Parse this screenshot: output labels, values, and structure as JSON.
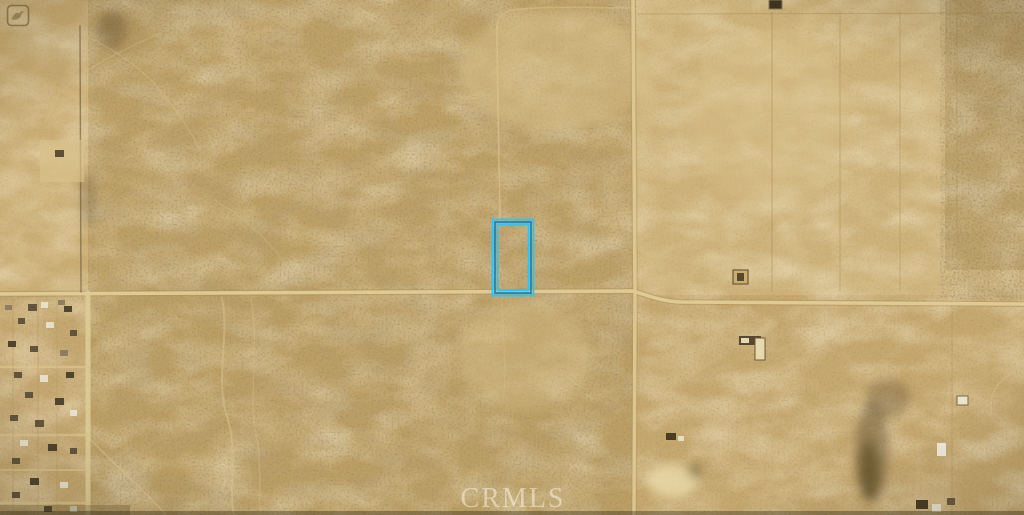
{
  "map": {
    "type": "satellite-aerial-photo",
    "watermark_text": "CRMLS",
    "corner_logo": "bird-badge-watermark",
    "palette": {
      "terrain_base": "#c6a870",
      "terrain_dark_scrub": "#b09153",
      "terrain_light_field": "#d4ba80",
      "road": "#e2cc97",
      "parcel_outline": "#33c3ee",
      "parcel_core_line": "#0f7fb4"
    },
    "parcel": {
      "x": 495,
      "y": 222,
      "w": 36,
      "h": 71
    },
    "features": {
      "roads": [
        {
          "name": "main-road-casing",
          "d": "M0 294 L633 291 C652 297 662 301 680 302 L1024 304",
          "stroke": "#ab8e58",
          "w": 6,
          "o": 0.45
        },
        {
          "name": "crossroad-casing",
          "d": "M633 0 L635 291 L634 515",
          "stroke": "#ab8e58",
          "w": 6,
          "o": 0.4
        },
        {
          "name": "main-road",
          "d": "M0 294 L633 291 C652 297 662 301 680 302 L1024 304",
          "stroke": "#e2cc97",
          "w": 3.5,
          "o": 0.95
        },
        {
          "name": "crossroad",
          "d": "M633 0 L635 291 L634 515",
          "stroke": "#e0ca95",
          "w": 3.5,
          "o": 0.9
        },
        {
          "name": "residential-edge-road",
          "d": "M88 293 L88 515",
          "stroke": "#decb96",
          "w": 5,
          "o": 0.9
        },
        {
          "name": "fence-line-west",
          "d": "M80 26 L81 292",
          "stroke": "#5e4a2b",
          "w": 1.4,
          "o": 0.55
        }
      ],
      "boundaries": [
        {
          "name": "field-line-1",
          "d": "M772 12 L772 291",
          "stroke": "#a3864f",
          "w": 1,
          "o": 0.5
        },
        {
          "name": "field-line-2",
          "d": "M840 12 L840 291",
          "stroke": "#a3864f",
          "w": 1,
          "o": 0.45
        },
        {
          "name": "field-line-3",
          "d": "M900 12 L900 291",
          "stroke": "#a3864f",
          "w": 1,
          "o": 0.4
        },
        {
          "name": "field-line-4",
          "d": "M957 12 L957 240",
          "stroke": "#a3864f",
          "w": 1,
          "o": 0.35
        },
        {
          "name": "field-line-top",
          "d": "M638 14 L1024 13",
          "stroke": "#a3864f",
          "w": 1,
          "o": 0.4
        },
        {
          "name": "field-line-se",
          "d": "M952 300 L952 515",
          "stroke": "#a3864f",
          "w": 1,
          "o": 0.35
        }
      ],
      "trails": [
        {
          "name": "trail-parcel-north",
          "d": "M497 26 C497 70 499 150 500 221",
          "stroke": "#dcc690",
          "w": 1.6,
          "o": 0.6
        },
        {
          "name": "trail-parcel-bend",
          "d": "M497 28 C497 16 505 10 520 9 C560 6 600 8 632 8",
          "stroke": "#dcc690",
          "w": 1.5,
          "o": 0.45
        },
        {
          "name": "trail-below-parcel",
          "d": "M501 294 C503 330 506 360 504 396",
          "stroke": "#d9c38d",
          "w": 1.3,
          "o": 0.3
        },
        {
          "name": "trail-wash-1",
          "d": "M222 298 C230 340 214 380 228 420 C238 452 228 488 234 515",
          "stroke": "#d9c38d",
          "w": 2,
          "o": 0.5
        },
        {
          "name": "trail-wash-2",
          "d": "M251 299 C260 348 247 398 257 440 C263 470 257 496 261 515",
          "stroke": "#d9c38d",
          "w": 1.5,
          "o": 0.35
        },
        {
          "name": "trail-diag-sw",
          "d": "M88 437 C118 468 148 494 166 515",
          "stroke": "#dcc690",
          "w": 1.8,
          "o": 0.5
        },
        {
          "name": "trail-nw-1",
          "d": "M32 18 C70 28 100 40 130 62 C160 84 185 120 200 150",
          "stroke": "#d9c38d",
          "w": 1.4,
          "o": 0.35
        },
        {
          "name": "trail-nw-2",
          "d": "M172 28 C140 42 105 58 78 76 C62 88 52 104 46 122",
          "stroke": "#d9c38d",
          "w": 1.4,
          "o": 0.3
        },
        {
          "name": "trail-center-wash",
          "d": "M300 291 C285 255 255 225 215 200",
          "stroke": "#d9c38d",
          "w": 1.5,
          "o": 0.25
        },
        {
          "name": "trail-east-curve",
          "d": "M1014 372 C996 382 988 396 992 414",
          "stroke": "#dcc690",
          "w": 1.5,
          "o": 0.4
        },
        {
          "name": "trail-junction-diag",
          "d": "M940 266 L906 294",
          "stroke": "#d9c38d",
          "w": 1.2,
          "o": 0.3
        }
      ],
      "streets": [
        {
          "name": "street-1",
          "d": "M0 367 L88 367",
          "stroke": "#d9c38d",
          "w": 2.5,
          "o": 0.8
        },
        {
          "name": "street-2",
          "d": "M0 435 L88 435",
          "stroke": "#d9c38d",
          "w": 2.5,
          "o": 0.8
        },
        {
          "name": "street-3",
          "d": "M0 470 L88 470",
          "stroke": "#d9c38d",
          "w": 2,
          "o": 0.7
        },
        {
          "name": "street-4",
          "d": "M0 503 L88 503",
          "stroke": "#d9c38d",
          "w": 2.5,
          "o": 0.8
        },
        {
          "name": "lot-line-1",
          "d": "M13 300 L13 510",
          "stroke": "#a88b55",
          "w": 0.8,
          "o": 0.4
        },
        {
          "name": "lot-line-2",
          "d": "M38 300 L38 510",
          "stroke": "#a88b55",
          "w": 0.8,
          "o": 0.4
        },
        {
          "name": "lot-line-3",
          "d": "M57 300 L57 510",
          "stroke": "#a88b55",
          "w": 0.8,
          "o": 0.35
        }
      ],
      "soft_shapes": [
        {
          "name": "light-area-topcenter",
          "cx": 555,
          "cy": 70,
          "rx": 95,
          "ry": 60,
          "fill": "#d8c089",
          "o": 0.5
        },
        {
          "name": "light-wash-center",
          "cx": 525,
          "cy": 355,
          "rx": 65,
          "ry": 55,
          "fill": "#d6bf88",
          "o": 0.4
        },
        {
          "name": "light-east-mid",
          "cx": 770,
          "cy": 120,
          "rx": 80,
          "ry": 90,
          "fill": "#d9c28c",
          "o": 0.35
        },
        {
          "name": "scrub-blob-1",
          "cx": 112,
          "cy": 30,
          "rx": 15,
          "ry": 20,
          "fill": "#5f4b2b",
          "o": 0.35
        },
        {
          "name": "scrub-blob-2",
          "cx": 88,
          "cy": 200,
          "rx": 9,
          "ry": 26,
          "fill": "#5f4b2b",
          "o": 0.3
        },
        {
          "name": "burn-scar-upper",
          "cx": 888,
          "cy": 398,
          "rx": 22,
          "ry": 19,
          "fill": "#6f5a38",
          "o": 0.4
        },
        {
          "name": "burn-scar-main",
          "cx": 872,
          "cy": 452,
          "rx": 17,
          "ry": 50,
          "fill": "#5e4c2c",
          "o": 0.45
        },
        {
          "name": "burn-scar-core",
          "cx": 869,
          "cy": 470,
          "rx": 10,
          "ry": 30,
          "fill": "#473717",
          "o": 0.5
        },
        {
          "name": "sand-pond",
          "cx": 672,
          "cy": 481,
          "rx": 25,
          "ry": 16,
          "fill": "#e8d7a6",
          "o": 0.85
        },
        {
          "name": "sand-pond-dark",
          "cx": 695,
          "cy": 471,
          "rx": 8,
          "ry": 6,
          "fill": "#54441f",
          "o": 0.55
        }
      ],
      "structures": [
        {
          "name": "small-building-topright",
          "x": 769,
          "y": 0,
          "w": 13,
          "h": 9,
          "fill": "#3f3522",
          "stroke": "#8a7a55",
          "sw": 1
        },
        {
          "name": "fenced-lot",
          "x": 733,
          "y": 270,
          "w": 15,
          "h": 14,
          "fill": "#c9ad72",
          "stroke": "#6d5937",
          "sw": 1.2
        },
        {
          "name": "fenced-lot-inner",
          "x": 737,
          "y": 273,
          "w": 7,
          "h": 8,
          "fill": "#58482c"
        },
        {
          "name": "farm-building-a",
          "x": 739,
          "y": 336,
          "w": 22,
          "h": 9,
          "fill": "#57472e"
        },
        {
          "name": "farm-building-b",
          "x": 755,
          "y": 338,
          "w": 10,
          "h": 22,
          "fill": "#e7d9ae",
          "stroke": "#6d5937",
          "sw": 1
        },
        {
          "name": "farm-building-c",
          "x": 741,
          "y": 338,
          "w": 8,
          "h": 5,
          "fill": "#e7d9ae"
        },
        {
          "name": "white-structure-1",
          "x": 957,
          "y": 396,
          "w": 11,
          "h": 9,
          "fill": "#eae3d0",
          "stroke": "#7a6a45",
          "sw": 1
        },
        {
          "name": "white-structure-2",
          "x": 937,
          "y": 443,
          "w": 9,
          "h": 13,
          "fill": "#efe9da"
        },
        {
          "name": "small-structure-east",
          "x": 666,
          "y": 433,
          "w": 10,
          "h": 7,
          "fill": "#4a3d27"
        },
        {
          "name": "small-structure-east-2",
          "x": 678,
          "y": 436,
          "w": 6,
          "h": 5,
          "fill": "#e5ddc8"
        },
        {
          "name": "homestead-patch",
          "x": 40,
          "y": 140,
          "w": 44,
          "h": 42,
          "fill": "#d9c28c",
          "o": 0.65
        },
        {
          "name": "homestead-building",
          "x": 55,
          "y": 150,
          "w": 9,
          "h": 7,
          "fill": "#5d4e34"
        },
        {
          "name": "bottom-cluster-1",
          "x": 916,
          "y": 500,
          "w": 12,
          "h": 9,
          "fill": "#4a3d27"
        },
        {
          "name": "bottom-cluster-2",
          "x": 932,
          "y": 504,
          "w": 9,
          "h": 8,
          "fill": "#e8e0cd"
        },
        {
          "name": "bottom-cluster-3",
          "x": 947,
          "y": 498,
          "w": 8,
          "h": 7,
          "fill": "#6b5b3e"
        }
      ],
      "house_colors": [
        "#5d4f39",
        "#e8e1ce",
        "#4a3e2b",
        "#8a7a5f"
      ],
      "houses": [
        [
          28,
          304,
          9,
          7,
          0
        ],
        [
          41,
          302,
          7,
          6,
          1
        ],
        [
          64,
          306,
          8,
          6,
          2
        ],
        [
          18,
          318,
          7,
          6,
          0
        ],
        [
          46,
          322,
          8,
          6,
          1
        ],
        [
          70,
          330,
          7,
          6,
          0
        ],
        [
          8,
          341,
          8,
          6,
          2
        ],
        [
          30,
          346,
          8,
          6,
          0
        ],
        [
          60,
          350,
          8,
          6,
          3
        ],
        [
          14,
          372,
          8,
          6,
          0
        ],
        [
          40,
          375,
          8,
          7,
          1
        ],
        [
          66,
          372,
          8,
          6,
          2
        ],
        [
          25,
          392,
          8,
          6,
          0
        ],
        [
          55,
          398,
          9,
          7,
          2
        ],
        [
          70,
          410,
          7,
          6,
          1
        ],
        [
          10,
          415,
          8,
          6,
          0
        ],
        [
          35,
          420,
          9,
          7,
          0
        ],
        [
          20,
          440,
          8,
          6,
          1
        ],
        [
          48,
          444,
          9,
          7,
          2
        ],
        [
          70,
          448,
          7,
          6,
          0
        ],
        [
          12,
          458,
          8,
          6,
          0
        ],
        [
          30,
          478,
          9,
          7,
          2
        ],
        [
          60,
          482,
          8,
          6,
          1
        ],
        [
          12,
          492,
          8,
          6,
          0
        ],
        [
          44,
          506,
          8,
          6,
          0
        ],
        [
          70,
          506,
          7,
          6,
          1
        ],
        [
          58,
          300,
          7,
          5,
          3
        ],
        [
          5,
          305,
          7,
          5,
          3
        ]
      ]
    }
  }
}
